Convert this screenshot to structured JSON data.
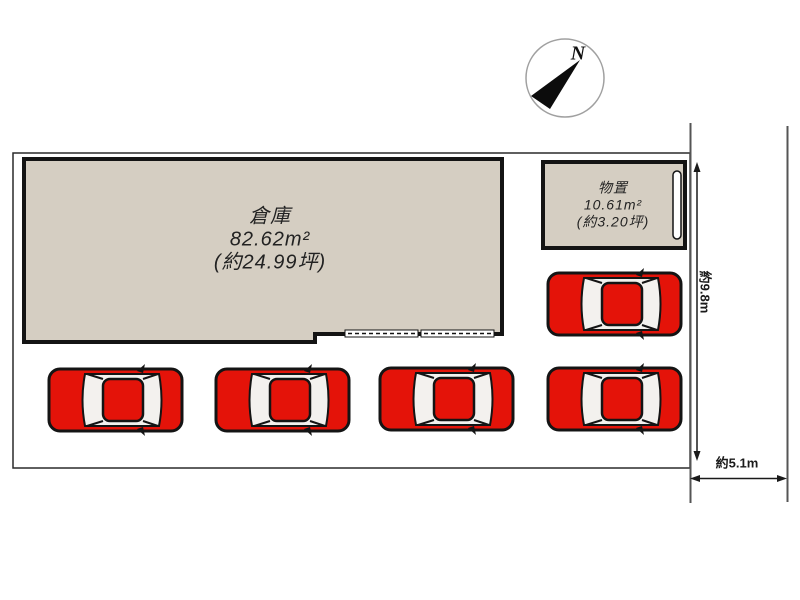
{
  "compass": {
    "label": "N"
  },
  "buildings": {
    "warehouse": {
      "name": "倉庫",
      "area": "82.62m²",
      "area_tsubo": "(約24.99坪)"
    },
    "shed": {
      "name": "物置",
      "area": "10.61m²",
      "area_tsubo": "(約3.20坪)"
    }
  },
  "dimensions": {
    "vertical": "約9.8m",
    "horizontal": "約5.1m"
  },
  "parking": {
    "car_count": 5
  },
  "colors": {
    "building_fill": "#d5cec2",
    "building_outline": "#141414",
    "plot_boundary": "#2a2a2a",
    "road_line": "#555555",
    "car_red": "#e41309",
    "compass_ring": "#a0a0a0"
  }
}
